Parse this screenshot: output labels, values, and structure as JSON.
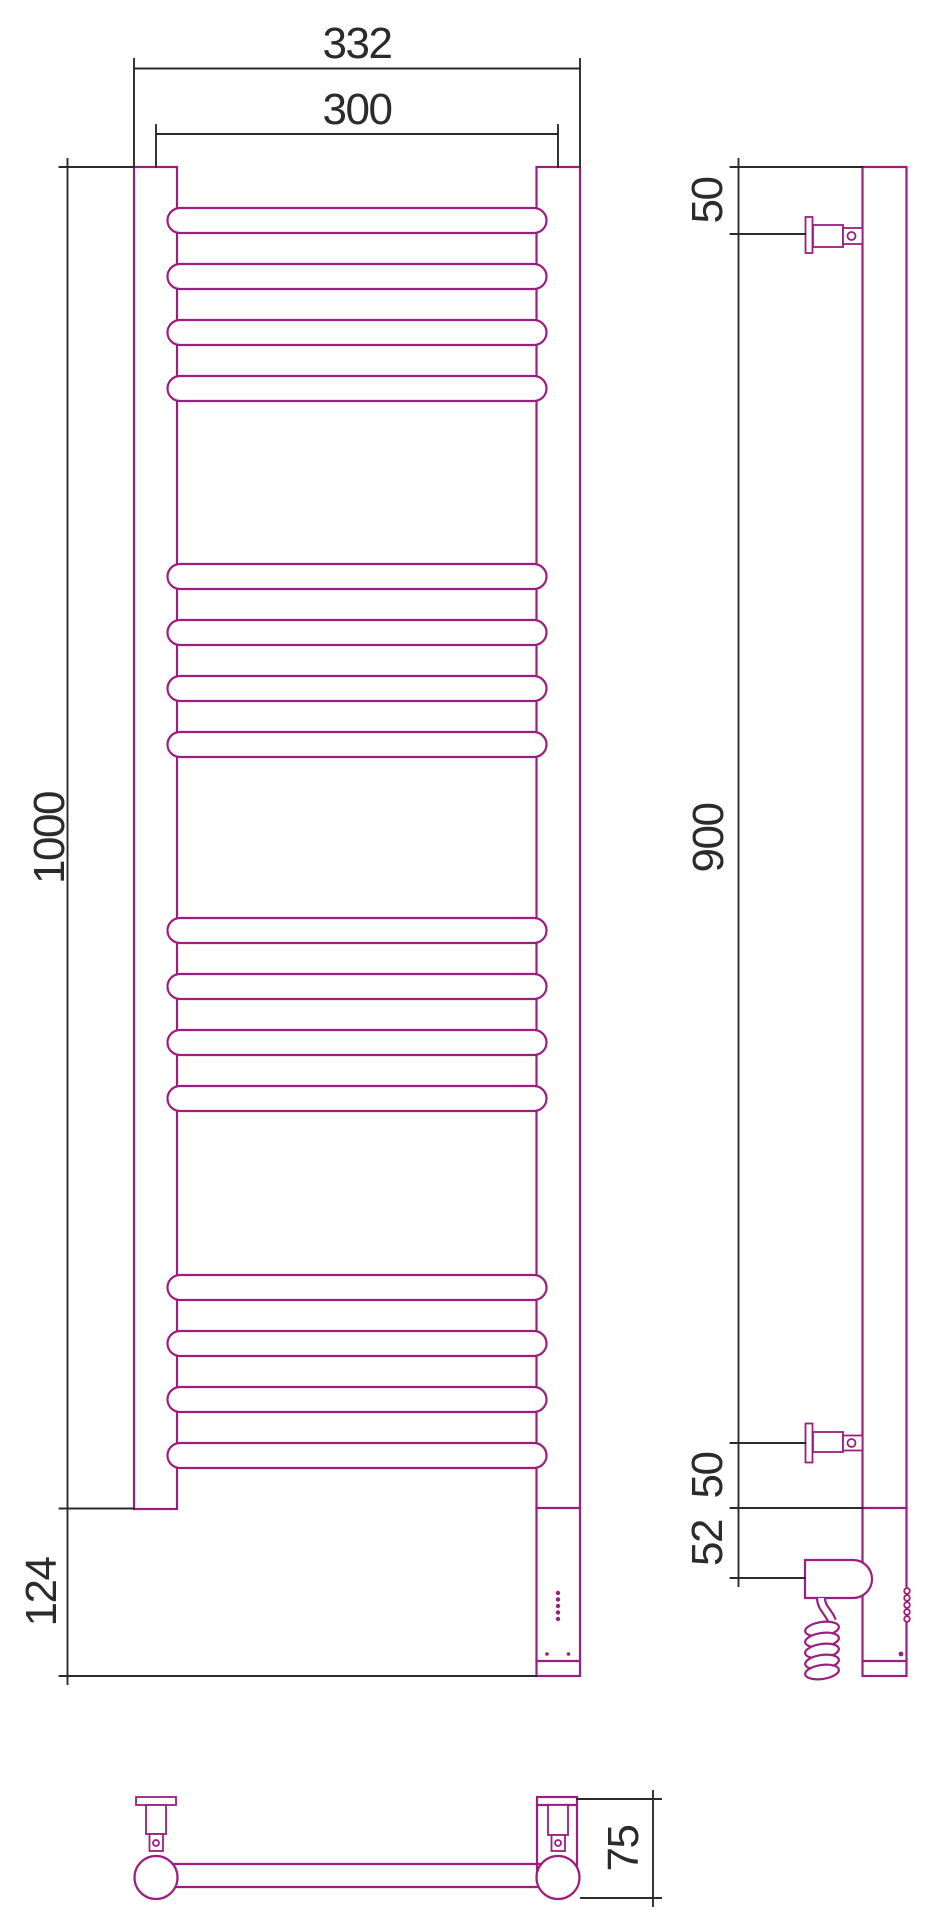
{
  "drawing": {
    "description": "Technical dimension drawing of an electric heated towel rail, three orthographic views",
    "colors": {
      "outline": "#9C1E7E",
      "dimension": "#2B2B2B",
      "background": "#FFFFFF"
    },
    "front_view": {
      "overall_width": "332",
      "rail_centers_width": "300",
      "body_height": "1000",
      "heater_section_height": "124"
    },
    "side_view": {
      "top_bracket_offset": "50",
      "bracket_span": "900",
      "bottom_bracket_offset": "50",
      "heating_element_offset": "52"
    },
    "bottom_view": {
      "wall_depth": "75"
    }
  }
}
